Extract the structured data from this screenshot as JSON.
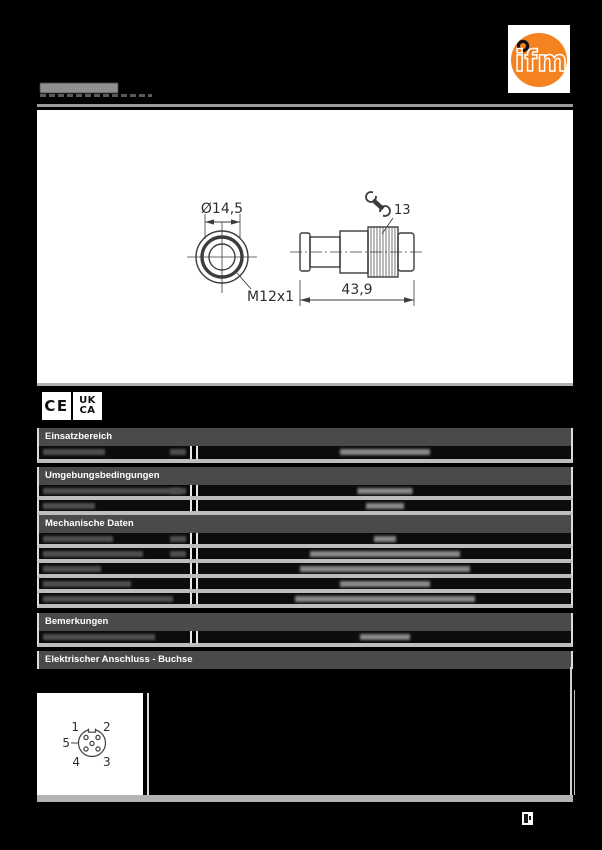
{
  "masthead": {
    "logo_text": "ifm",
    "logo_orange": "#f58220",
    "product_code_redacted": true
  },
  "drawing": {
    "dim_diameter": "Ø14,5",
    "thread_label": "M12x1",
    "length_dim": "43,9",
    "wrench_size": "13"
  },
  "marks": {
    "ce": "CE",
    "ukca_top": "UK",
    "ukca_bottom": "CA"
  },
  "table": {
    "header_bg": "#4a4a4a",
    "row_divider_color": "#bdbdbd",
    "sections": [
      {
        "title": "Einsatzbereich",
        "redacted_rows": 1
      },
      {
        "title": "Umgebungsbedingungen",
        "redacted_rows": 2
      },
      {
        "title": "Mechanische Daten",
        "redacted_rows": 5
      },
      {
        "title": "Bemerkungen",
        "redacted_rows": 1
      },
      {
        "title": "Elektrischer Anschluss - Buchse",
        "redacted_rows": 0
      }
    ]
  },
  "pinout": {
    "p1": "1",
    "p2": "2",
    "p3": "3",
    "p4": "4",
    "p5": "5"
  },
  "page": {
    "bg": "#000000"
  }
}
